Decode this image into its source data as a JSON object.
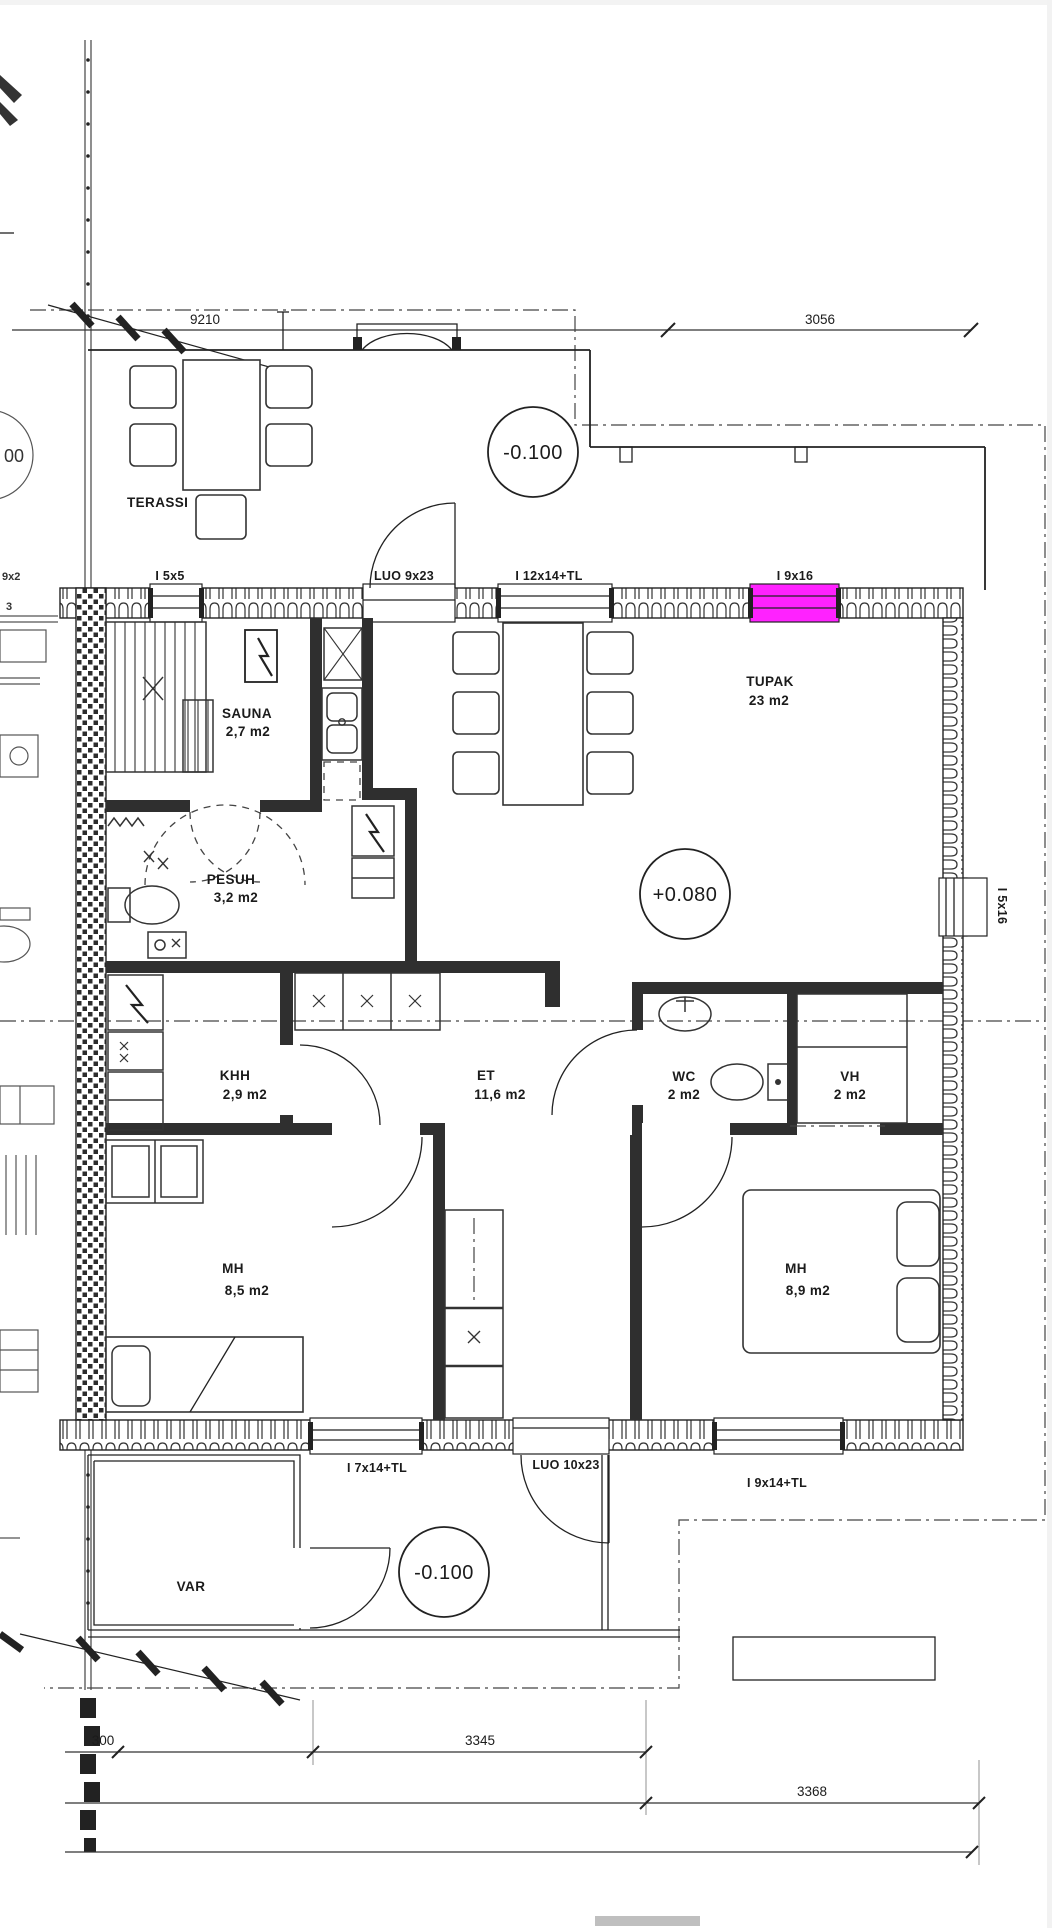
{
  "dims": {
    "d9210": "9210",
    "d3056": "3056",
    "d300": "300",
    "d3345": "3345",
    "d3368": "3368"
  },
  "levels": {
    "terrace": "-0.100",
    "interior": "+0.080",
    "porch": "-0.100"
  },
  "rooms": {
    "terassi": {
      "name": "TERASSI"
    },
    "sauna": {
      "name": "SAUNA",
      "area": "2,7 m2"
    },
    "tupak": {
      "name": "TUPAK",
      "area": "23 m2"
    },
    "pesuh": {
      "name": "PESUH",
      "area": "3,2 m2"
    },
    "khh": {
      "name": "KHH",
      "area": "2,9 m2"
    },
    "et": {
      "name": "ET",
      "area": "11,6 m2"
    },
    "wc": {
      "name": "WC",
      "area": "2 m2"
    },
    "vh": {
      "name": "VH",
      "area": "2 m2"
    },
    "mh_left": {
      "name": "MH",
      "area": "8,5 m2"
    },
    "mh_right": {
      "name": "MH",
      "area": "8,9 m2"
    },
    "var": {
      "name": "VAR"
    }
  },
  "openings": {
    "i5x5": "I 5x5",
    "luo9x23": "LUO 9x23",
    "i12x14tl": "I 12x14+TL",
    "i9x16": "I 9x16",
    "i5x16": "I 5x16",
    "i7x14tl": "I 7x14+TL",
    "luo10x23": "LUO 10x23",
    "i9x14tl": "I 9x14+TL"
  },
  "neighbor": {
    "frag1": "00",
    "frag2": "9x2",
    "frag3": "3"
  }
}
